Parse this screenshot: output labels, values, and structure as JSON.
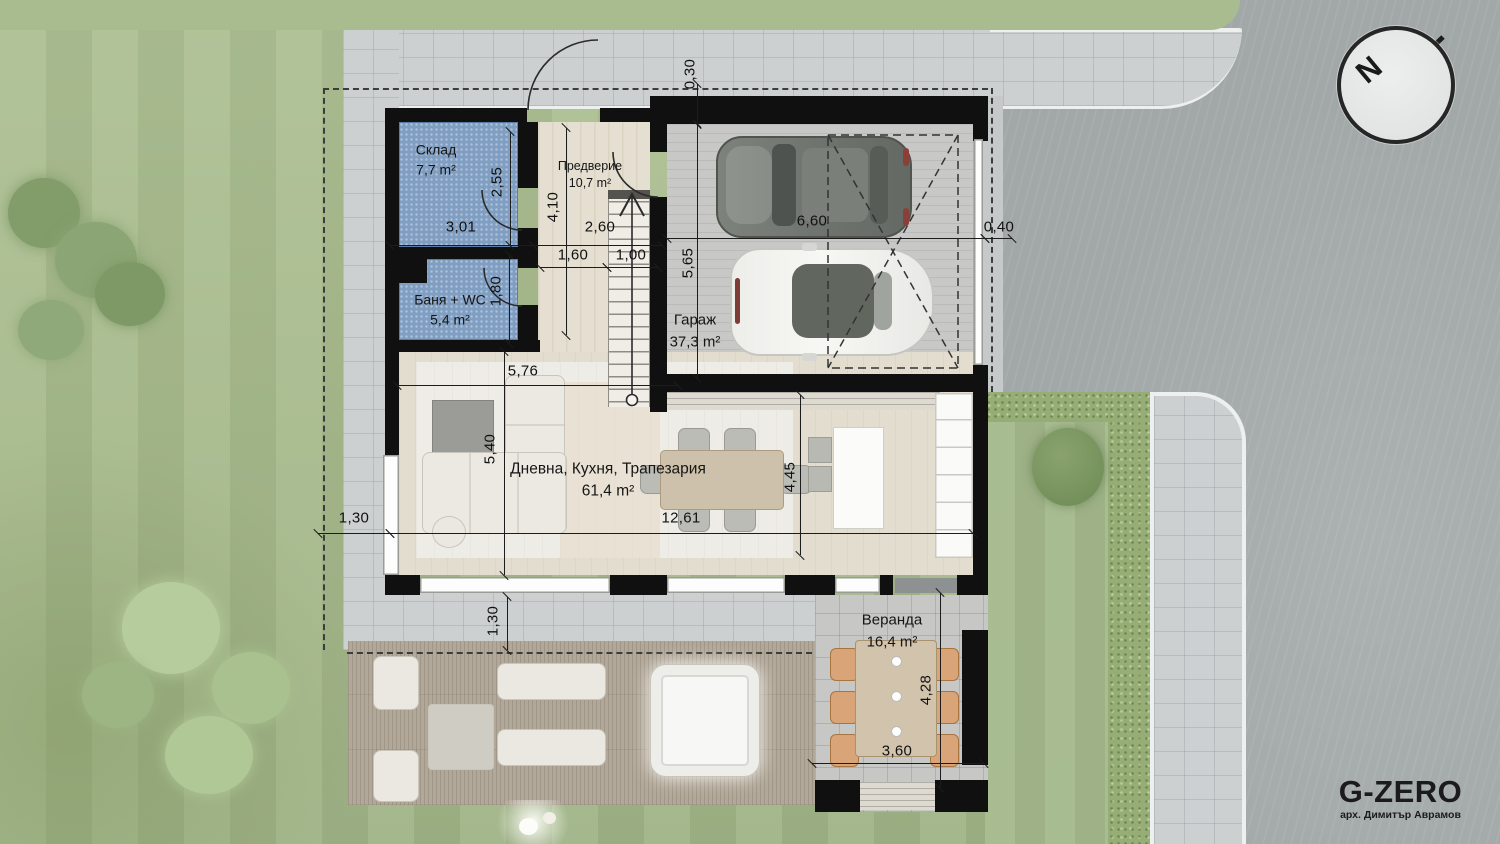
{
  "compass": {
    "label": "N"
  },
  "brand": {
    "name": "G-ZERO",
    "subtitle": "арх. Димитър Аврамов"
  },
  "rooms": {
    "storage": {
      "name": "Склад",
      "area": "7,7 m²"
    },
    "entry": {
      "name": "Предверие",
      "area": "10,7 m²"
    },
    "bath": {
      "name": "Баня + WC",
      "area": "5,4 m²"
    },
    "garage": {
      "name": "Гараж",
      "area": "37,3 m²"
    },
    "living": {
      "name": "Дневна, Кухня, Трапезария",
      "area": "61,4 m²"
    },
    "veranda": {
      "name": "Веранда",
      "area": "16,4 m²"
    }
  },
  "dimensions": {
    "d030": "0,30",
    "d040": "0,40",
    "d100": "1,00",
    "d130a": "1,30",
    "d130b": "1,30",
    "d160": "1,60",
    "d180": "1,80",
    "d255": "2,55",
    "d260": "2,60",
    "d301": "3,01",
    "d360": "3,60",
    "d410": "4,10",
    "d428": "4,28",
    "d445": "4,45",
    "d540": "5,40",
    "d565": "5,65",
    "d576": "5,76",
    "d660": "6,60",
    "d1261": "12,61"
  },
  "colors": {
    "wall": "#101010",
    "wet_room_floor": "#7f9ec2",
    "lawn": "#a8bc8f",
    "street": "#a2a8a8",
    "paving": "#ccd0d1",
    "deck": "#b2a899",
    "veranda_chair": "#d9a478"
  }
}
